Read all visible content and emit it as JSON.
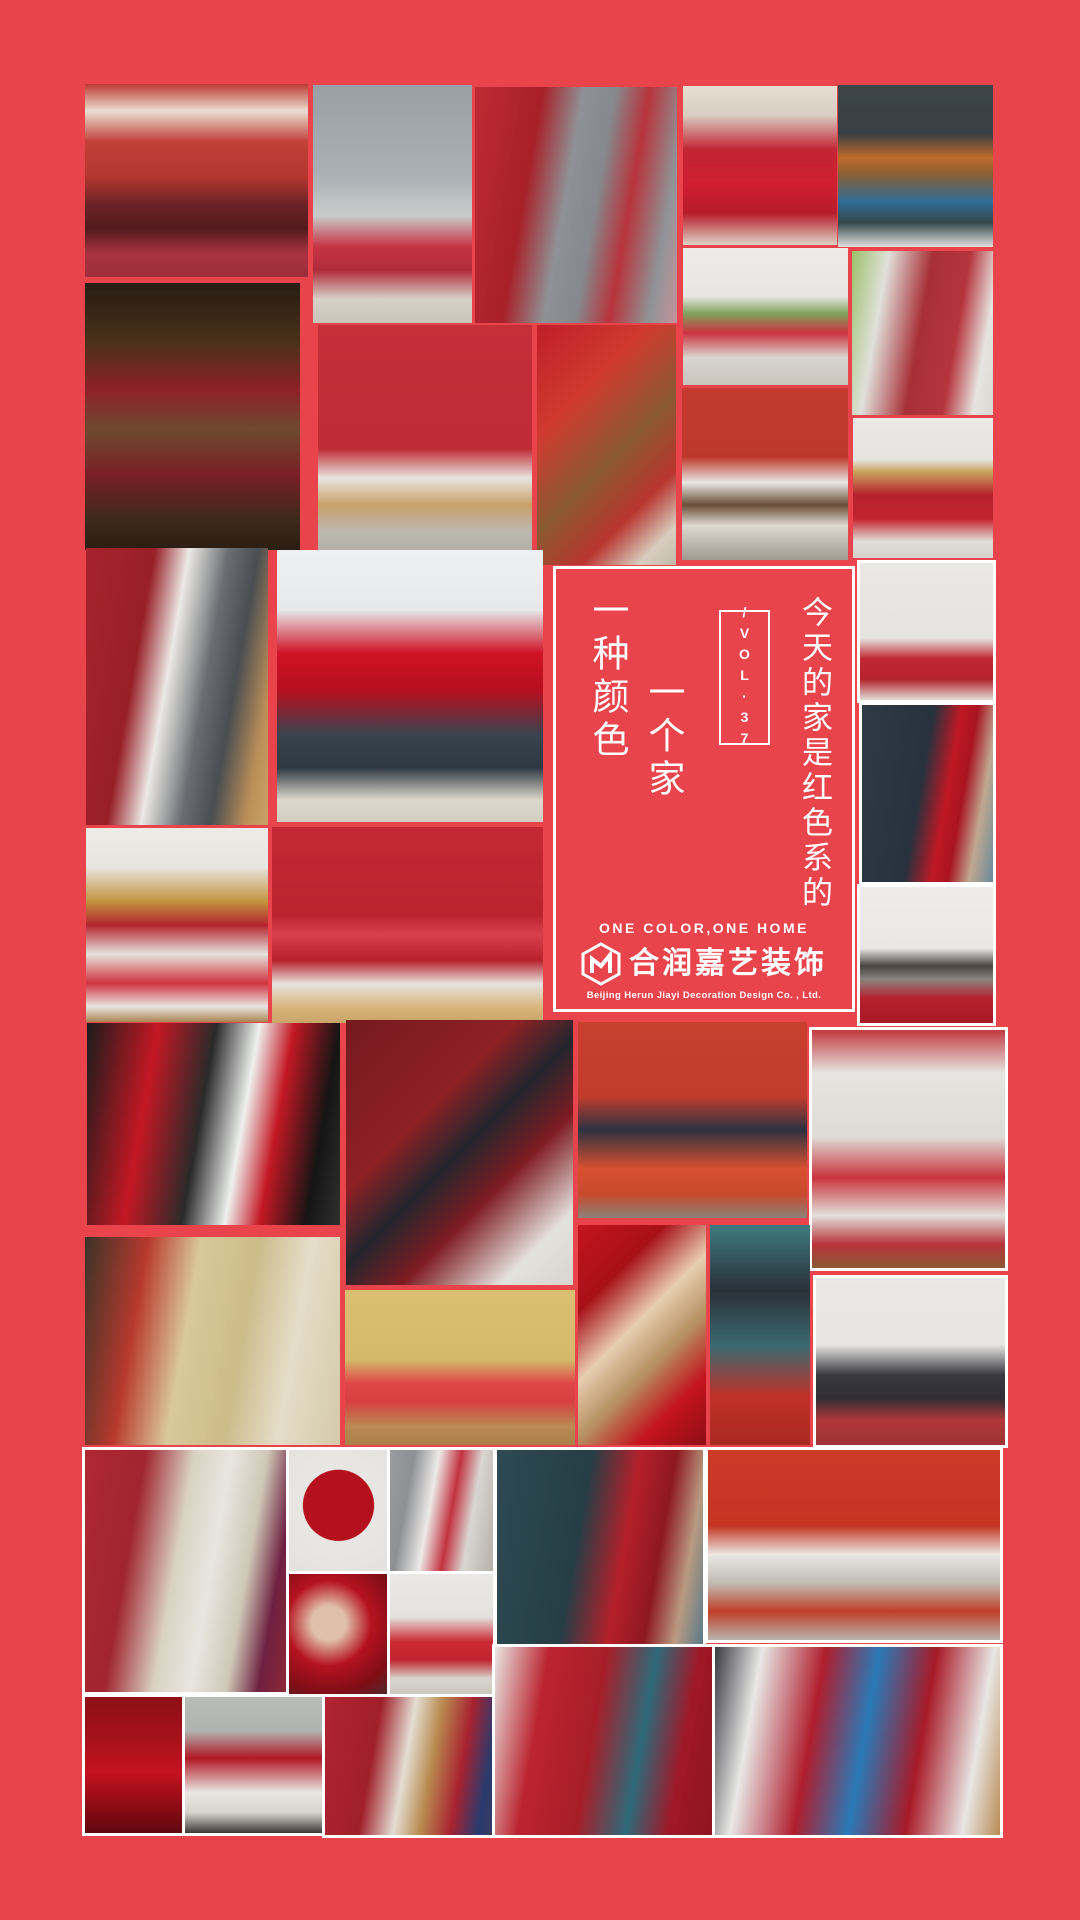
{
  "poster": {
    "background_color": "#e9444c",
    "frame_border_color": "#ffffff",
    "headline": "今天的家是红色系的",
    "vol_box": {
      "text": "/VOL·37"
    },
    "card": {
      "line1": "一种颜色",
      "line2": "一个家"
    },
    "brand": {
      "tagline": "ONE COLOR,ONE HOME",
      "name": "合润嘉艺装饰",
      "subtitle": "Beijing Herun Jiayi Decoration Design Co. , Ltd."
    },
    "collage": {
      "photos": [
        {
          "name": "photo-red-curtain-living-room",
          "x": 85,
          "y": 84,
          "w": 223,
          "h": 193,
          "bordered": false,
          "bg": "linear-gradient(180deg,#bd3a33 0%,#e9ded0 14%,#c14038 30%,#b5372f 48%,#6e2327 62%,#531a1e 75%,#aa3340 88%,#9d2e3a 100%)"
        },
        {
          "name": "photo-gray-room-red-daybed",
          "x": 313,
          "y": 85,
          "w": 159,
          "h": 238,
          "bordered": false,
          "bg": "linear-gradient(180deg,#98a0a5 0%,#aab0b4 38%,#c9ccca 55%,#c53343 68%,#b12d3c 78%,#d6d2c8 90%,#c9c4ba 100%)"
        },
        {
          "name": "photo-red-gray-wallpaper-room",
          "x": 475,
          "y": 87,
          "w": 202,
          "h": 236,
          "bordered": false,
          "bg": "linear-gradient(100deg,#bf2b33 0%,#a82028 28%,#8e9296 45%,#85898d 58%,#b8343c 72%,#8f9396 88%,#c5939b 100%)"
        },
        {
          "name": "photo-woman-red-lace-dress",
          "x": 683,
          "y": 86,
          "w": 154,
          "h": 159,
          "bordered": false,
          "bg": "linear-gradient(180deg,#e5ddd0 0%,#d8cfc2 18%,#c22533 40%,#cf1f30 62%,#b81c2b 80%,#ddd3c5 100%)"
        },
        {
          "name": "photo-teal-room-blue-chair",
          "x": 838,
          "y": 85,
          "w": 155,
          "h": 162,
          "bordered": false,
          "bg": "linear-gradient(180deg,#3c4547 0%,#384043 30%,#c06a2a 45%,#8a5f35 55%,#2f6d95 72%,#35484c 85%,#e3e2de 100%)"
        },
        {
          "name": "photo-rustic-beam-living-room",
          "x": 85,
          "y": 283,
          "w": 215,
          "h": 267,
          "bordered": false,
          "bg": "linear-gradient(180deg,#271c13 0%,#4a3119 22%,#8e2129 40%,#6e4a2e 55%,#7a1f26 72%,#3e2a1c 88%,#2c1e14 100%)"
        },
        {
          "name": "photo-red-wall-pendant-chair",
          "x": 318,
          "y": 325,
          "w": 214,
          "h": 225,
          "bordered": false,
          "bg": "linear-gradient(180deg,#c42f38 0%,#bf2c35 55%,#e7e4df 68%,#c8a06a 80%,#bdb8b0 92%,#b3aea6 100%)"
        },
        {
          "name": "photo-red-staircase-hall",
          "x": 537,
          "y": 325,
          "w": 139,
          "h": 240,
          "bordered": false,
          "bg": "linear-gradient(135deg,#c01f2a 0%,#d03a2e 30%,#8a5a33 55%,#b8352e 75%,#d8cfc0 90%,#c0b8a8 100%)"
        },
        {
          "name": "photo-white-room-red-sofa",
          "x": 683,
          "y": 248,
          "w": 165,
          "h": 137,
          "bordered": false,
          "bg": "linear-gradient(180deg,#edebe7 0%,#e8e6e2 35%,#7fa05a 48%,#cc3342 62%,#d8d5cf 80%,#c9c5bd 100%)"
        },
        {
          "name": "photo-red-bedroom-white-dresser",
          "x": 852,
          "y": 251,
          "w": 141,
          "h": 164,
          "bordered": false,
          "bg": "linear-gradient(100deg,#9cc06a 0%,#e0e0da 22%,#a83038 48%,#b5343c 70%,#e6e4e0 88%,#d9d7d1 100%)"
        },
        {
          "name": "photo-red-tv-wall-unit",
          "x": 682,
          "y": 388,
          "w": 166,
          "h": 172,
          "bordered": false,
          "bg": "linear-gradient(180deg,#c43b2e 0%,#bd382c 40%,#e8e6e2 55%,#6a4f38 68%,#ddd9d1 80%,#a09a90 100%)"
        },
        {
          "name": "photo-red-bedspread-bedroom",
          "x": 853,
          "y": 418,
          "w": 140,
          "h": 140,
          "bordered": false,
          "bg": "linear-gradient(180deg,#ebe9e5 0%,#e5e3df 30%,#c9a55e 38%,#b5222c 55%,#c3242e 72%,#e0ddd6 88%,#d5d2cb 100%)"
        },
        {
          "name": "photo-bedroom-red-curtain-divider",
          "x": 86,
          "y": 548,
          "w": 182,
          "h": 277,
          "bordered": false,
          "bg": "linear-gradient(100deg,#a8232c 0%,#981f27 30%,#ebe9e5 45%,#6a6e72 62%,#4a4e52 75%,#bb8e58 90%,#caa267 100%)"
        },
        {
          "name": "photo-red-fridge-kitchen",
          "x": 277,
          "y": 550,
          "w": 266,
          "h": 272,
          "bordered": false,
          "bg": "linear-gradient(180deg,#eef0f2 0%,#e6e8ea 22%,#d01225 38%,#b5101f 52%,#39434e 68%,#2f3943 80%,#ddd8cc 92%,#d2cdc1 100%)"
        },
        {
          "name": "photo-white-shelf-red-decor",
          "x": 86,
          "y": 828,
          "w": 182,
          "h": 194,
          "bordered": false,
          "bg": "linear-gradient(180deg,#edebe7 0%,#e8e5e0 20%,#c29240 38%,#b5242e 50%,#e5e2dc 65%,#cf3440 80%,#e8e5e0 92%,#ab8553 100%)"
        },
        {
          "name": "photo-red-wall-neon-squares",
          "x": 272,
          "y": 827,
          "w": 271,
          "h": 196,
          "bordered": false,
          "bg": "linear-gradient(180deg,#c42833 0%,#bb242e 45%,#d8404e 55%,#b8202a 68%,#e6e3de 80%,#d9b57c 92%,#caa467 100%)"
        },
        {
          "name": "photo-nursery-red-dashed-wall",
          "x": 860,
          "y": 563,
          "w": 133,
          "h": 137,
          "bordered": true,
          "bg": "linear-gradient(180deg,#eae8e4 0%,#e5e3df 55%,#c02832 70%,#b5242e 85%,#e0ddd6 100%)"
        },
        {
          "name": "photo-red-chesterfield-firehose",
          "x": 862,
          "y": 705,
          "w": 131,
          "h": 177,
          "bordered": true,
          "bg": "linear-gradient(100deg,#2e3a46 0%,#28323e 45%,#c01824 62%,#a81420 72%,#c0a890 85%,#6a8a9a 100%)"
        },
        {
          "name": "photo-white-dining-red-rug",
          "x": 860,
          "y": 887,
          "w": 133,
          "h": 136,
          "bordered": true,
          "bg": "linear-gradient(180deg,#edecea 0%,#e9e8e6 45%,#4a4440 58%,#8a8480 68%,#b5202c 82%,#a81a26 100%)"
        },
        {
          "name": "photo-red-kitchen-black-tiles",
          "x": 87,
          "y": 1023,
          "w": 253,
          "h": 202,
          "bordered": false,
          "bg": "linear-gradient(100deg,#1c1c1c 0%,#c41824 25%,#2a2a2a 45%,#eef0ee 60%,#c41824 72%,#151515 88%,#303030 100%)"
        },
        {
          "name": "photo-dark-red-shelves-bedroom",
          "x": 346,
          "y": 1020,
          "w": 227,
          "h": 265,
          "bordered": false,
          "bg": "linear-gradient(135deg,#751a20 0%,#8e2026 35%,#23272d 50%,#7e1c22 65%,#e3e1db 85%,#d8d5ce 100%)"
        },
        {
          "name": "photo-gallery-wall-orange-sofa",
          "x": 578,
          "y": 1022,
          "w": 229,
          "h": 196,
          "bordered": false,
          "bg": "linear-gradient(180deg,#c8402e 0%,#c23c2c 38%,#2d3242 55%,#d8502f 75%,#c84a2e 88%,#8a8278 100%)"
        },
        {
          "name": "photo-white-red-dresser-mirrors",
          "x": 812,
          "y": 1030,
          "w": 193,
          "h": 238,
          "bordered": true,
          "bg": "linear-gradient(180deg,#c03a40 0%,#e6e4e0 18%,#dddbd5 45%,#c9343c 62%,#e2e0da 78%,#b8333b 90%,#8a5a33 100%)"
        },
        {
          "name": "photo-beige-living-room-fireplace",
          "x": 85,
          "y": 1237,
          "w": 255,
          "h": 208,
          "bordered": false,
          "bg": "linear-gradient(100deg,#3c3428 0%,#b8392e 22%,#d9c89a 40%,#cdbb8a 60%,#e4ddc8 78%,#d5c9a8 100%)"
        },
        {
          "name": "photo-yellow-wall-red-sofa",
          "x": 345,
          "y": 1290,
          "w": 230,
          "h": 155,
          "bordered": false,
          "bg": "linear-gradient(180deg,#d8c070 0%,#d2ba6a 45%,#e04848 60%,#d84040 72%,#b98a54 88%,#aa7e4a 100%)"
        },
        {
          "name": "photo-woman-red-hood-portrait",
          "x": 578,
          "y": 1225,
          "w": 128,
          "h": 220,
          "bordered": false,
          "bg": "linear-gradient(135deg,#c4141e 0%,#a81018 25%,#e8cdb0 45%,#b59060 62%,#c4141e 80%,#8e0e16 100%)"
        },
        {
          "name": "photo-teal-bookshelf-red-armchair",
          "x": 710,
          "y": 1225,
          "w": 100,
          "h": 220,
          "bordered": false,
          "bg": "linear-gradient(180deg,#3f7a80 0%,#2a3038 30%,#3a6a70 55%,#c03028 78%,#a82a22 100%)"
        },
        {
          "name": "photo-gray-room-dark-sofa",
          "x": 816,
          "y": 1278,
          "w": 189,
          "h": 167,
          "bordered": true,
          "bg": "linear-gradient(180deg,#eae9e7 0%,#e6e5e3 40%,#3a3a40 58%,#2e2e34 72%,#b0383a 85%,#9e3234 100%)"
        },
        {
          "name": "photo-red-floral-wallpaper-room",
          "x": 85,
          "y": 1450,
          "w": 202,
          "h": 242,
          "bordered": true,
          "bg": "linear-gradient(100deg,#b02832 0%,#a02530 25%,#d9d2c2 45%,#e8e6e0 60%,#cfc8b8 75%,#6e2040 88%,#8e2838 100%)"
        },
        {
          "name": "photo-rose-petal-bath",
          "x": 289,
          "y": 1450,
          "w": 99,
          "h": 123,
          "bordered": true,
          "bg": "radial-gradient(circle at 50% 45%, #b5101d 0%, #b5101d 42%, #e9e7e3 43%, #e3e1dd 100%)"
        },
        {
          "name": "photo-gray-curtain-living-room",
          "x": 390,
          "y": 1450,
          "w": 103,
          "h": 123,
          "bordered": true,
          "bg": "linear-gradient(100deg,#9a9ca0 0%,#8e9094 20%,#eceae8 40%,#c23240 58%,#d8d6d2 75%,#b5b0a8 100%)"
        },
        {
          "name": "photo-teal-wall-red-chesterfield",
          "x": 497,
          "y": 1450,
          "w": 206,
          "h": 195,
          "bordered": true,
          "bg": "linear-gradient(100deg,#2e4a52 0%,#263e46 40%,#b5202a 60%,#8e1820 75%,#b99a80 88%,#5a7a8a 100%)"
        },
        {
          "name": "photo-big-red-tv-wall-living",
          "x": 708,
          "y": 1450,
          "w": 292,
          "h": 190,
          "bordered": true,
          "bg": "linear-gradient(180deg,#cc3a28 0%,#c43522 40%,#eae8e4 55%,#c0bcb4 70%,#c04028 85%,#b8b4ac 100%)"
        },
        {
          "name": "photo-woman-red-tulle-portrait",
          "x": 289,
          "y": 1574,
          "w": 99,
          "h": 123,
          "bordered": true,
          "bg": "radial-gradient(circle at 40% 40%, #e0c0a8 0%, #e0c0a8 18%, #b5121f 45%, #7e0e16 75%, #4a2e2e 100%)"
        },
        {
          "name": "photo-red-sofa-floral-curtains",
          "x": 390,
          "y": 1574,
          "w": 103,
          "h": 123,
          "bordered": true,
          "bg": "linear-gradient(180deg,#eae8e4 0%,#e4e2de 35%,#cc2a35 55%,#c0242e 70%,#d8d5cf 85%,#c9c5bd 100%)"
        },
        {
          "name": "photo-woman-red-gown",
          "x": 85,
          "y": 1697,
          "w": 98,
          "h": 136,
          "bordered": true,
          "bg": "linear-gradient(180deg,#8e0f16 0%,#a5121a 30%,#c41220 55%,#8e0c14 80%,#5e080e 100%)"
        },
        {
          "name": "photo-red-art-white-armchairs",
          "x": 185,
          "y": 1697,
          "w": 137,
          "h": 136,
          "bordered": true,
          "bg": "linear-gradient(180deg,#b9bcb9 0%,#b0b3b0 25%,#b01824 45%,#e9e7e3 70%,#d5d3cd 85%,#3a3a38 100%)"
        },
        {
          "name": "photo-guitar-wall-red-room",
          "x": 325,
          "y": 1697,
          "w": 167,
          "h": 138,
          "bordered": true,
          "bg": "linear-gradient(100deg,#b02430 0%,#a01f2a 30%,#e3ded2 48%,#b98a50 62%,#a82230 78%,#2a3a6e 92%,#343c60 100%)"
        },
        {
          "name": "photo-red-salon-drip-art",
          "x": 495,
          "y": 1647,
          "w": 218,
          "h": 188,
          "bordered": true,
          "bg": "linear-gradient(100deg,#e8e6e2 0%,#bb2430 22%,#a81e28 45%,#2e6a7a 65%,#a01828 82%,#8e1420 100%)"
        },
        {
          "name": "photo-red-blue-apartment",
          "x": 715,
          "y": 1647,
          "w": 285,
          "h": 188,
          "bordered": true,
          "bg": "linear-gradient(100deg,#3a3a42 0%,#e8e8e6 15%,#b01e2e 35%,#2a7ab8 52%,#a81a28 70%,#e8e6e4 88%,#b98a54 100%)"
        }
      ]
    }
  }
}
